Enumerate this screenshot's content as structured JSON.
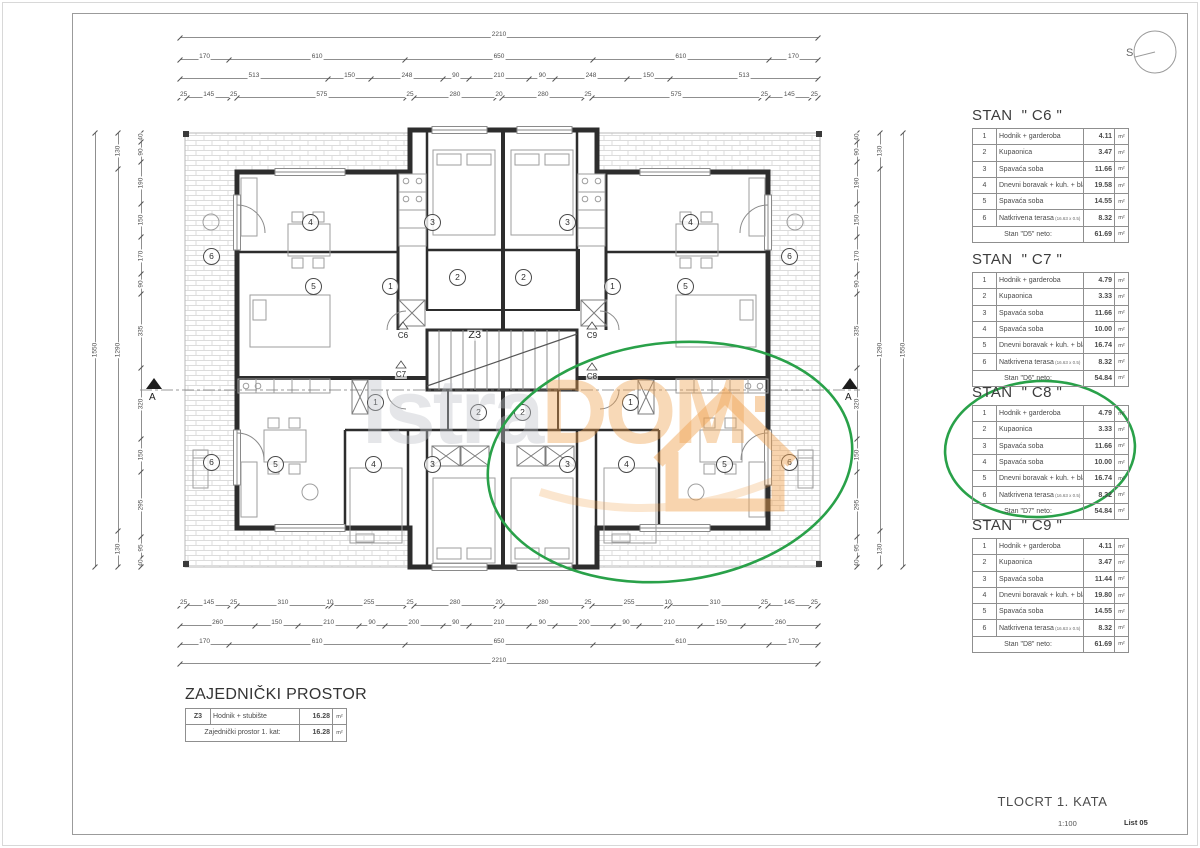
{
  "sheet": {
    "footer_title": "TLOCRT 1. KATA",
    "scale": "1:100",
    "sheet_no": "List 05"
  },
  "compass": {
    "label": "S"
  },
  "section": {
    "label": "A"
  },
  "watermark": {
    "part1": "Istra",
    "part2": "DOM"
  },
  "unit": "m²",
  "colors": {
    "highlight_green": "#29a149",
    "watermark_orange": "#f0a14e"
  },
  "apartments": [
    {
      "title": "STAN  \" C6 \"",
      "rows": [
        {
          "n": "1",
          "name": "Hodnik + garderoba",
          "v": "4.11"
        },
        {
          "n": "2",
          "name": "Kupaonica",
          "v": "3.47"
        },
        {
          "n": "3",
          "name": "Spavaća soba",
          "v": "11.66"
        },
        {
          "n": "4",
          "name": "Dnevni boravak + kuh. + blag.",
          "v": "19.58"
        },
        {
          "n": "5",
          "name": "Spavaća soba",
          "v": "14.55"
        },
        {
          "n": "6",
          "name": "Natkrivena terasa",
          "sub": "(16.63 x 0.5)",
          "v": "8.32"
        }
      ],
      "total_label": "Stan \"D5\" neto:",
      "total": "61.69"
    },
    {
      "title": "STAN  \" C7 \"",
      "rows": [
        {
          "n": "1",
          "name": "Hodnik + garderoba",
          "v": "4.79"
        },
        {
          "n": "2",
          "name": "Kupaonica",
          "v": "3.33"
        },
        {
          "n": "3",
          "name": "Spavaća soba",
          "v": "11.66"
        },
        {
          "n": "4",
          "name": "Spavaća soba",
          "v": "10.00"
        },
        {
          "n": "5",
          "name": "Dnevni boravak + kuh. + blag.",
          "v": "16.74"
        },
        {
          "n": "6",
          "name": "Natkrivena terasa",
          "sub": "(16.63 x 0.5)",
          "v": "8.32"
        }
      ],
      "total_label": "Stan \"D6\" neto:",
      "total": "54.84"
    },
    {
      "title": "STAN  \" C8 \"",
      "highlighted": true,
      "rows": [
        {
          "n": "1",
          "name": "Hodnik + garderoba",
          "v": "4.79"
        },
        {
          "n": "2",
          "name": "Kupaonica",
          "v": "3.33"
        },
        {
          "n": "3",
          "name": "Spavaća soba",
          "v": "11.66"
        },
        {
          "n": "4",
          "name": "Spavaća soba",
          "v": "10.00"
        },
        {
          "n": "5",
          "name": "Dnevni boravak + kuh. + blag.",
          "v": "16.74"
        },
        {
          "n": "6",
          "name": "Natkrivena terasa",
          "sub": "(16.63 x 0.5)",
          "v": "8.32"
        }
      ],
      "total_label": "Stan \"D7\" neto:",
      "total": "54.84"
    },
    {
      "title": "STAN  \" C9 \"",
      "rows": [
        {
          "n": "1",
          "name": "Hodnik + garderoba",
          "v": "4.11"
        },
        {
          "n": "2",
          "name": "Kupaonica",
          "v": "3.47"
        },
        {
          "n": "3",
          "name": "Spavaća soba",
          "v": "11.44"
        },
        {
          "n": "4",
          "name": "Dnevni boravak + kuh. + blag.",
          "v": "19.80"
        },
        {
          "n": "5",
          "name": "Spavaća soba",
          "v": "14.55"
        },
        {
          "n": "6",
          "name": "Natkrivena terasa",
          "sub": "(16.63 x 0.5)",
          "v": "8.32"
        }
      ],
      "total_label": "Stan \"D8\" neto:",
      "total": "61.69"
    }
  ],
  "common_area": {
    "title": "ZAJEDNIČKI PROSTOR",
    "rows": [
      {
        "n": "Z3",
        "name": "Hodnik + stubište",
        "v": "16.28"
      }
    ],
    "total_label": "Zajednički prostor 1. kat:",
    "total": "16.28"
  },
  "plan": {
    "room_markers": [
      {
        "x": 310,
        "y": 222,
        "n": "4"
      },
      {
        "x": 432,
        "y": 222,
        "n": "3"
      },
      {
        "x": 313,
        "y": 286,
        "n": "5"
      },
      {
        "x": 390,
        "y": 286,
        "n": "1"
      },
      {
        "x": 457,
        "y": 277,
        "n": "2"
      },
      {
        "x": 211,
        "y": 256,
        "n": "6"
      },
      {
        "x": 567,
        "y": 222,
        "n": "3"
      },
      {
        "x": 690,
        "y": 222,
        "n": "4"
      },
      {
        "x": 612,
        "y": 286,
        "n": "1"
      },
      {
        "x": 685,
        "y": 286,
        "n": "5"
      },
      {
        "x": 523,
        "y": 277,
        "n": "2"
      },
      {
        "x": 789,
        "y": 256,
        "n": "6"
      },
      {
        "x": 375,
        "y": 402,
        "n": "1"
      },
      {
        "x": 478,
        "y": 412,
        "n": "2"
      },
      {
        "x": 432,
        "y": 464,
        "n": "3"
      },
      {
        "x": 373,
        "y": 464,
        "n": "4"
      },
      {
        "x": 275,
        "y": 464,
        "n": "5"
      },
      {
        "x": 211,
        "y": 462,
        "n": "6"
      },
      {
        "x": 630,
        "y": 402,
        "n": "1"
      },
      {
        "x": 522,
        "y": 412,
        "n": "2"
      },
      {
        "x": 567,
        "y": 464,
        "n": "3"
      },
      {
        "x": 626,
        "y": 464,
        "n": "4"
      },
      {
        "x": 724,
        "y": 464,
        "n": "5"
      },
      {
        "x": 789,
        "y": 462,
        "n": "6"
      }
    ],
    "unit_markers": [
      {
        "x": 403,
        "y": 336,
        "t": "C6"
      },
      {
        "x": 475,
        "y": 335,
        "t": "Z3",
        "big": true
      },
      {
        "x": 592,
        "y": 336,
        "t": "C9"
      },
      {
        "x": 401,
        "y": 375,
        "t": "C7"
      },
      {
        "x": 592,
        "y": 377,
        "t": "C8"
      }
    ]
  },
  "dimensions": [
    {
      "edge": "top",
      "x": 180,
      "y": 30,
      "len": 638,
      "dir": "h",
      "values": [
        2210
      ]
    },
    {
      "edge": "top",
      "x": 180,
      "y": 52,
      "len": 638,
      "dir": "h",
      "values": [
        170,
        610,
        650,
        610,
        170
      ]
    },
    {
      "edge": "top",
      "x": 180,
      "y": 71,
      "len": 638,
      "dir": "h",
      "values": [
        513,
        150,
        248,
        90,
        210,
        90,
        248,
        150,
        513
      ]
    },
    {
      "edge": "top",
      "x": 180,
      "y": 90,
      "len": 638,
      "dir": "h",
      "values": [
        25,
        145,
        25,
        575,
        25,
        280,
        20,
        280,
        25,
        575,
        25,
        145,
        25
      ]
    },
    {
      "edge": "bottom",
      "x": 180,
      "y": 598,
      "len": 638,
      "dir": "h",
      "values": [
        25,
        145,
        25,
        310,
        10,
        255,
        25,
        280,
        20,
        280,
        25,
        255,
        10,
        310,
        25,
        145,
        25
      ]
    },
    {
      "edge": "bottom",
      "x": 180,
      "y": 618,
      "len": 638,
      "dir": "h",
      "values": [
        260,
        150,
        210,
        90,
        200,
        90,
        210,
        90,
        200,
        90,
        210,
        150,
        260
      ]
    },
    {
      "edge": "bottom",
      "x": 180,
      "y": 637,
      "len": 638,
      "dir": "h",
      "values": [
        170,
        610,
        650,
        610,
        170
      ]
    },
    {
      "edge": "bottom",
      "x": 180,
      "y": 656,
      "len": 638,
      "dir": "h",
      "values": [
        2210
      ]
    },
    {
      "edge": "left",
      "x": 91,
      "y": 133,
      "len": 434,
      "dir": "v",
      "values": [
        1550
      ]
    },
    {
      "edge": "left",
      "x": 114,
      "y": 133,
      "len": 434,
      "dir": "v",
      "values": [
        130,
        1290,
        130
      ]
    },
    {
      "edge": "left",
      "x": 137,
      "y": 133,
      "len": 434,
      "dir": "v",
      "values": [
        40,
        90,
        190,
        150,
        170,
        90,
        335,
        320,
        150,
        295,
        95,
        40
      ]
    },
    {
      "edge": "right",
      "x": 853,
      "y": 133,
      "len": 434,
      "dir": "v",
      "values": [
        40,
        90,
        190,
        150,
        170,
        90,
        335,
        320,
        150,
        295,
        95,
        40
      ]
    },
    {
      "edge": "right",
      "x": 876,
      "y": 133,
      "len": 434,
      "dir": "v",
      "values": [
        130,
        1290,
        130
      ]
    },
    {
      "edge": "right",
      "x": 899,
      "y": 133,
      "len": 434,
      "dir": "v",
      "values": [
        1550
      ]
    }
  ]
}
